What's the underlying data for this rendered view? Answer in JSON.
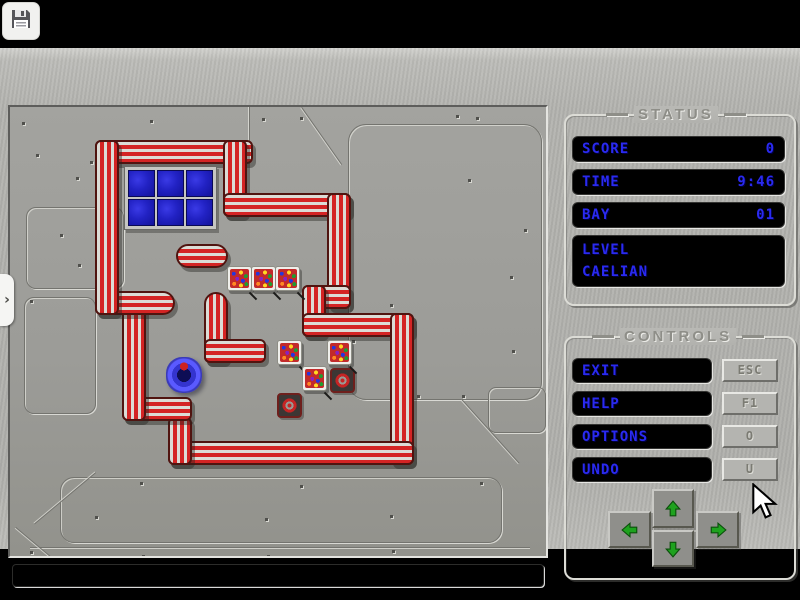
{
  "app": {
    "save_icon": "floppy-disk",
    "side_tab_glyph": "›"
  },
  "status_panel": {
    "title": "STATUS",
    "rows": [
      {
        "label": "SCORE",
        "value": "0"
      },
      {
        "label": "TIME",
        "value": "9:46"
      },
      {
        "label": "BAY",
        "value": "01"
      }
    ],
    "level_label": "LEVEL",
    "level_name": "CAELIAN"
  },
  "controls_panel": {
    "title": "CONTROLS",
    "buttons": [
      {
        "label": "EXIT",
        "key": "ESC"
      },
      {
        "label": "HELP",
        "key": "F1"
      },
      {
        "label": "OPTIONS",
        "key": "O"
      },
      {
        "label": "UNDO",
        "key": "U"
      }
    ],
    "dpad": [
      "up",
      "left",
      "right",
      "down"
    ]
  },
  "board": {
    "message_bar_text": "",
    "level_window": {
      "x": 114,
      "y": 59,
      "cols": 3,
      "rows": 2,
      "tile": 25
    },
    "walls": [
      {
        "x": 85,
        "y": 33,
        "w": 158,
        "h": 24,
        "dir": "h",
        "cap": ""
      },
      {
        "x": 213,
        "y": 33,
        "w": 24,
        "h": 77,
        "dir": "v",
        "cap": ""
      },
      {
        "x": 213,
        "y": 86,
        "w": 128,
        "h": 24,
        "dir": "h",
        "cap": ""
      },
      {
        "x": 317,
        "y": 86,
        "w": 24,
        "h": 116,
        "dir": "v",
        "cap": ""
      },
      {
        "x": 292,
        "y": 178,
        "w": 49,
        "h": 24,
        "dir": "h",
        "cap": ""
      },
      {
        "x": 292,
        "y": 178,
        "w": 24,
        "h": 52,
        "dir": "v",
        "cap": ""
      },
      {
        "x": 292,
        "y": 206,
        "w": 112,
        "h": 24,
        "dir": "h",
        "cap": ""
      },
      {
        "x": 380,
        "y": 206,
        "w": 24,
        "h": 152,
        "dir": "v",
        "cap": ""
      },
      {
        "x": 158,
        "y": 334,
        "w": 246,
        "h": 24,
        "dir": "h",
        "cap": ""
      },
      {
        "x": 158,
        "y": 310,
        "w": 24,
        "h": 48,
        "dir": "v",
        "cap": ""
      },
      {
        "x": 112,
        "y": 290,
        "w": 70,
        "h": 24,
        "dir": "h",
        "cap": ""
      },
      {
        "x": 112,
        "y": 184,
        "w": 24,
        "h": 130,
        "dir": "v",
        "cap": ""
      },
      {
        "x": 85,
        "y": 184,
        "w": 80,
        "h": 24,
        "dir": "h",
        "cap": "cap-right"
      },
      {
        "x": 85,
        "y": 33,
        "w": 24,
        "h": 175,
        "dir": "v",
        "cap": ""
      },
      {
        "x": 166,
        "y": 137,
        "w": 52,
        "h": 24,
        "dir": "h",
        "cap": "cap-both"
      },
      {
        "x": 194,
        "y": 185,
        "w": 24,
        "h": 71,
        "dir": "v",
        "cap": "cap-top"
      },
      {
        "x": 194,
        "y": 232,
        "w": 62,
        "h": 24,
        "dir": "h",
        "cap": ""
      }
    ],
    "crates": [
      {
        "x": 217,
        "y": 159
      },
      {
        "x": 241,
        "y": 159
      },
      {
        "x": 265,
        "y": 159
      },
      {
        "x": 267,
        "y": 233
      },
      {
        "x": 317,
        "y": 233
      },
      {
        "x": 292,
        "y": 259
      }
    ],
    "targets": [
      {
        "x": 320,
        "y": 261
      },
      {
        "x": 267,
        "y": 286
      }
    ],
    "player": {
      "x": 156,
      "y": 250
    },
    "decor": {
      "rivets": [
        [
          12,
          15
        ],
        [
          140,
          13
        ],
        [
          252,
          11
        ],
        [
          290,
          10
        ],
        [
          446,
          8
        ],
        [
          466,
          10
        ],
        [
          26,
          47
        ],
        [
          80,
          54
        ],
        [
          66,
          70
        ],
        [
          50,
          127
        ],
        [
          68,
          157
        ],
        [
          20,
          193
        ],
        [
          86,
          193
        ],
        [
          130,
          193
        ],
        [
          330,
          129
        ],
        [
          323,
          173
        ],
        [
          342,
          233
        ],
        [
          380,
          197
        ],
        [
          407,
          288
        ],
        [
          452,
          288
        ],
        [
          500,
          169
        ],
        [
          502,
          243
        ],
        [
          458,
          72
        ],
        [
          514,
          122
        ],
        [
          130,
          375
        ],
        [
          85,
          409
        ],
        [
          255,
          411
        ],
        [
          380,
          408
        ],
        [
          20,
          444
        ],
        [
          132,
          448
        ],
        [
          257,
          448
        ],
        [
          382,
          443
        ],
        [
          470,
          375
        ],
        [
          290,
          378
        ]
      ],
      "panels": [
        {
          "x": 338,
          "y": 17,
          "w": 192,
          "h": 274,
          "r": 18
        },
        {
          "x": 16,
          "y": 100,
          "w": 96,
          "h": 80,
          "r": 10
        },
        {
          "x": 14,
          "y": 190,
          "w": 70,
          "h": 115,
          "r": 10
        },
        {
          "x": 50,
          "y": 370,
          "w": 440,
          "h": 64,
          "r": 14
        },
        {
          "x": 478,
          "y": 280,
          "w": 56,
          "h": 44,
          "r": 8
        }
      ],
      "lines": [
        {
          "x": 240,
          "y": 0,
          "len": 36,
          "ang": 90
        },
        {
          "x": 292,
          "y": 0,
          "len": 70,
          "ang": 55
        },
        {
          "x": 86,
          "y": 366,
          "len": 80,
          "ang": 140
        },
        {
          "x": 20,
          "y": 440,
          "len": 500,
          "ang": 0
        },
        {
          "x": 6,
          "y": 420,
          "len": 46,
          "ang": 40
        },
        {
          "x": 452,
          "y": 292,
          "len": 86,
          "ang": 48
        }
      ]
    }
  },
  "colors": {
    "accent_blue": "#2a2af0",
    "pipe_red": "#d42424",
    "arrow_green": "#1ea21e",
    "metal": "#b2b2ae",
    "field": "#9c9c98"
  }
}
